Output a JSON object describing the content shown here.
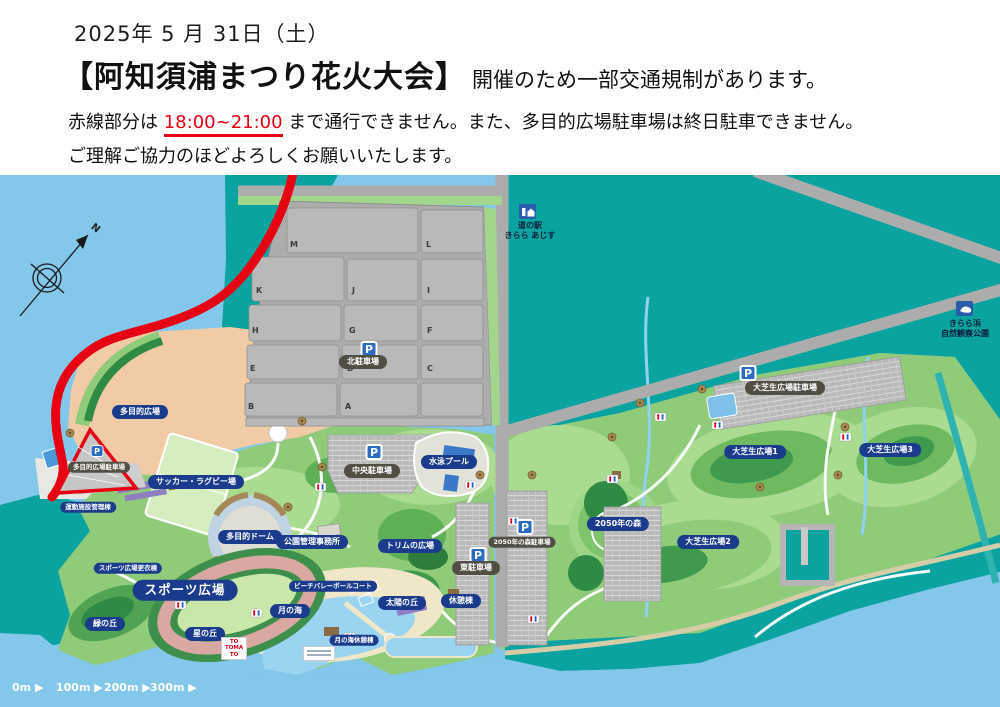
{
  "header": {
    "date": "2025年 5 月 31日（土）",
    "title": "【阿知須浦まつり花火大会】",
    "title_suffix": "開催のため一部交通規制があります。",
    "notice_prefix": "赤線部分は ",
    "notice_time": "18:00~21:00",
    "notice_suffix": " まで通行できません。また、多目的広場駐車場は終日駐車できません。",
    "notice_line2": "ご理解ご協力のほどよろしくお願いいたします。"
  },
  "map": {
    "compass": "N",
    "p": "P",
    "scale": [
      "0m ▶",
      "100m ▶",
      "200m ▶",
      "300m ▶"
    ],
    "north_lot": {
      "label": "北駐車場",
      "sections": [
        "M",
        "L",
        "K",
        "J",
        "I",
        "H",
        "G",
        "F",
        "E",
        "D",
        "C",
        "B",
        "A"
      ]
    },
    "stations": {
      "michinoeki_line1": "道の駅",
      "michinoeki_line2": "きらら あじす",
      "nature_line1": "きらら浜",
      "nature_line2": "自然観察公園"
    },
    "labels": {
      "tamokuteki_hiroba": "多目的広場",
      "tamokuteki_parking": "多目的広場駐車場",
      "undo_shisetsu": "運動施設管理棟",
      "soccer_rugby": "サッカー・ラグビー場",
      "chuo_parking": "中央駐車場",
      "pool": "水泳プール",
      "dome": "多目的ドーム",
      "koen_jimusho": "公園管理事務所",
      "trim": "トリムの広場",
      "sports_hiroba": "スポーツ広場",
      "sports_kigae": "スポーツ広場更衣棟",
      "midori_oka": "緑の丘",
      "hoshi_oka": "星の丘",
      "taiyo_oka": "太陽の丘",
      "kyukei": "休憩棟",
      "tsuki_umi": "月の海",
      "beach_volley": "ビーチバレーボールコート",
      "tsuki_kyukei": "月の海休憩棟",
      "higashi_parking": "東駐車場",
      "mori2050": "2050年の森",
      "mori2050_parking": "2050年の森駐車場",
      "oshiba_parking": "大芝生広場駐車場",
      "oshiba1": "大芝生広場1",
      "oshiba2": "大芝生広場2",
      "oshiba3": "大芝生広場3"
    },
    "tomato": {
      "l1": "TO",
      "l2": "TOMA",
      "l3": "TO"
    },
    "colors": {
      "restricted_red": "#E60012",
      "label_navy": "#1B3C8C",
      "parking_pill": "#514F44",
      "teal_water": "#0BA3A0",
      "sea_blue": "#83C7EB"
    }
  }
}
